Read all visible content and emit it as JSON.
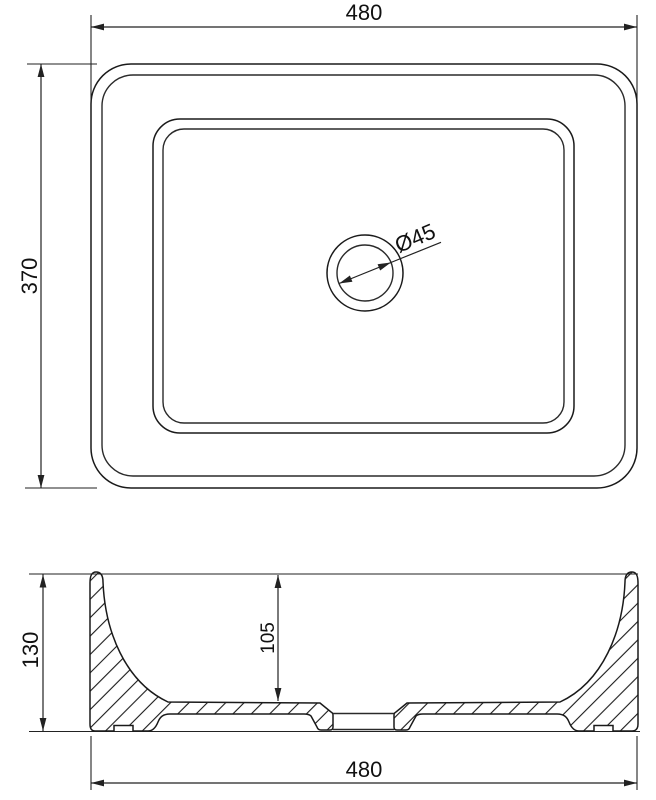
{
  "drawing": {
    "colors": {
      "line": "#1a1a1a",
      "background": "#ffffff"
    },
    "top_view": {
      "width_label": "480",
      "height_label": "370",
      "drain_label": "Ø45"
    },
    "section_view": {
      "height_label": "130",
      "depth_label": "105",
      "width_label": "480"
    }
  }
}
